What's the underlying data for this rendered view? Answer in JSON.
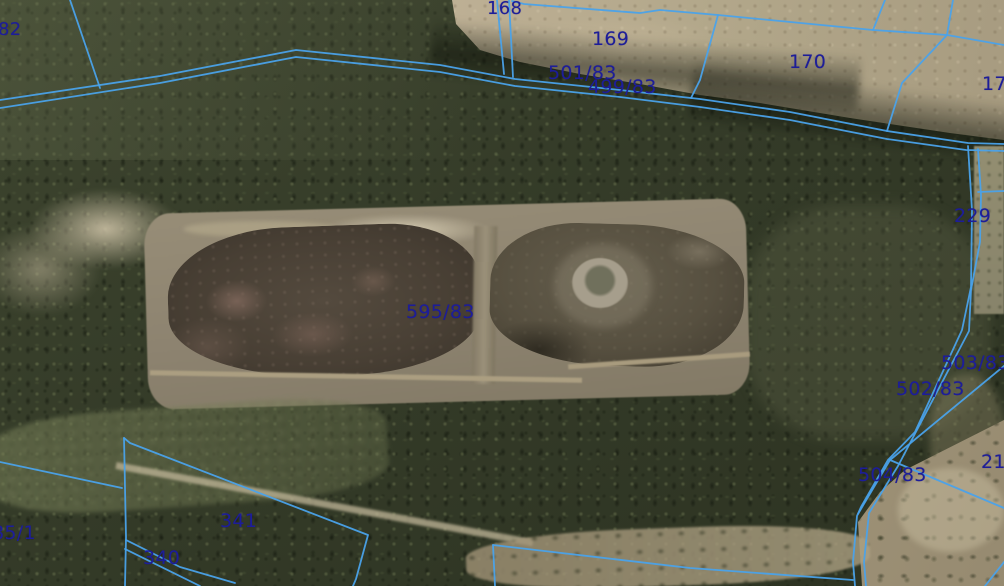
{
  "map": {
    "title": "Cadastral parcel map over aerial orthophoto",
    "line_color": "#4aa2ea",
    "label_color": "#1d1d99",
    "viewport": {
      "width_px": 1004,
      "height_px": 586
    },
    "parcel_labels": [
      {
        "text": "82",
        "x": -2,
        "y": 19,
        "size": 18
      },
      {
        "text": "168",
        "x": 487,
        "y": -2,
        "size": 18
      },
      {
        "text": "169",
        "x": 592,
        "y": 28,
        "size": 19
      },
      {
        "text": "501/83",
        "x": 548,
        "y": 62,
        "size": 19
      },
      {
        "text": "499/83",
        "x": 588,
        "y": 76,
        "size": 19
      },
      {
        "text": "170",
        "x": 789,
        "y": 51,
        "size": 19
      },
      {
        "text": "17",
        "x": 982,
        "y": 73,
        "size": 19
      },
      {
        "text": "229",
        "x": 954,
        "y": 205,
        "size": 19
      },
      {
        "text": "595/83",
        "x": 406,
        "y": 301,
        "size": 19
      },
      {
        "text": "503/83",
        "x": 941,
        "y": 352,
        "size": 19
      },
      {
        "text": "502/83",
        "x": 896,
        "y": 378,
        "size": 19
      },
      {
        "text": "21",
        "x": 981,
        "y": 451,
        "size": 19
      },
      {
        "text": "504/83",
        "x": 858,
        "y": 464,
        "size": 19
      },
      {
        "text": "341",
        "x": 220,
        "y": 510,
        "size": 19
      },
      {
        "text": "340",
        "x": 143,
        "y": 547,
        "size": 19
      },
      {
        "text": "85/1",
        "x": -8,
        "y": 522,
        "size": 19
      }
    ],
    "boundaries": [
      "70,0 100,88",
      "0,100 160,76 296,50 440,65 515,79 620,90 700,99 790,112 887,131 968,143 1004,144",
      "0,108 160,83 296,57 440,72 515,86 620,97 700,107 790,120 887,139 966,150 1004,151",
      "497,0 504,74",
      "509,0 513,77",
      "512,1 524,4 640,13 660,10 718,15 873,30 947,35 1004,45",
      "718,15 700,80 691,98",
      "885,0 873,30",
      "953,0 947,35",
      "947,35 902,83 887,131",
      "968,146 972,210 971,287 962,330 915,432 888,460 861,507 857,516 853,562 855,586",
      "978,149 981,195 980,242 971,290 969,331 898,466 869,513 864,562 866,586",
      "978,192 1004,191",
      "1004,366 890,460 858,514",
      "890,460 1004,508",
      "0,462 122,488",
      "124,438 126,537 125,586",
      "124,438 130,443 368,535 356,579 353,586",
      "126,540 180,567 235,583",
      "125,549 200,586",
      "493,545 495,586",
      "493,545 690,568 853,580",
      "1004,562 985,586"
    ]
  }
}
